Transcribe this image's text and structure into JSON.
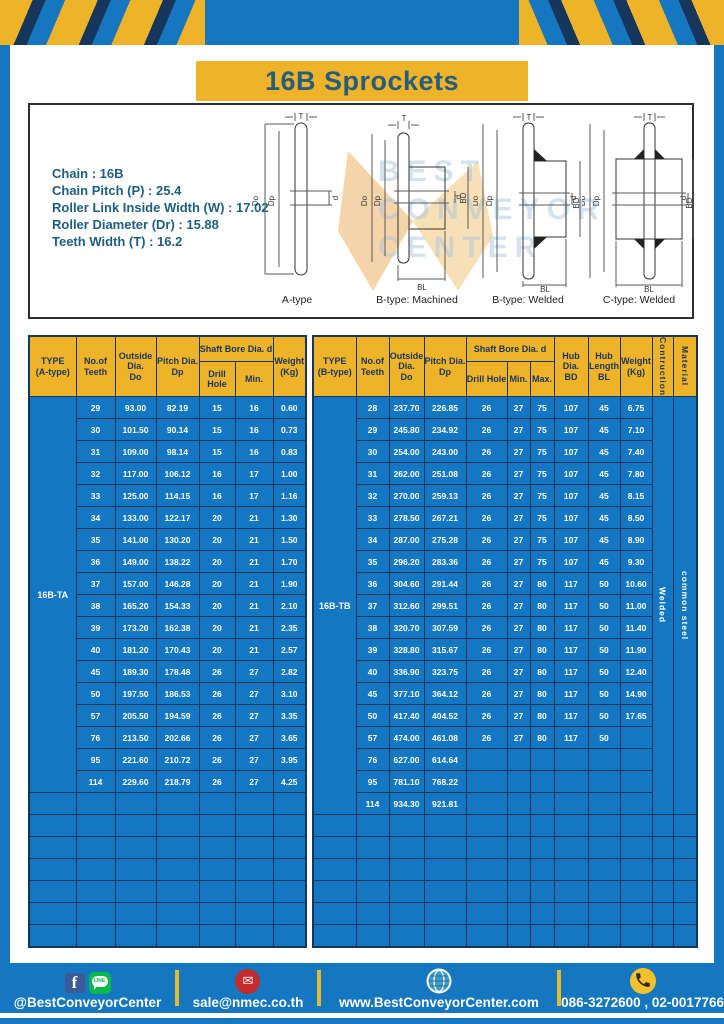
{
  "header": {
    "title": "16B Sprockets"
  },
  "specs": {
    "lines": [
      "Chain  :  16B",
      "Chain Pitch (P)  :  25.4",
      "Roller Link Inside Width (W)  :  17.02",
      "Roller Diameter (Dr)  : 15.88",
      "Teeth Width (T)  :  16.2"
    ]
  },
  "watermark": {
    "lines": [
      "BEST",
      "CONVEYOR",
      "CENTER"
    ]
  },
  "drawings": {
    "captions": [
      "A-type",
      "B-type: Machined",
      "B-type: Welded",
      "C-type: Welded"
    ],
    "dims": {
      "t": "T",
      "outer": "Do",
      "pitch": "Dp",
      "bore": "d",
      "hub_dia": "BD",
      "hub_len": "BL"
    }
  },
  "left_table": {
    "headers": {
      "type": "TYPE\n(A-type)",
      "teeth": "No.of\nTeeth",
      "outside": "Outside\nDia.\nDo",
      "pitch": "Pitch Dia.\nDp",
      "shaft_bore": "Shaft Bore Dia. d",
      "drill": "Drill Hole",
      "min": "Min.",
      "weight": "Weight\n(Kg)"
    },
    "type_label": "16B-TA",
    "total_cols": 7,
    "empty_rows": 7,
    "rows": [
      [
        "29",
        "93.00",
        "82.19",
        "15",
        "16",
        "0.60"
      ],
      [
        "30",
        "101.50",
        "90.14",
        "15",
        "16",
        "0.73"
      ],
      [
        "31",
        "109.00",
        "98.14",
        "15",
        "16",
        "0.83"
      ],
      [
        "32",
        "117.00",
        "106.12",
        "16",
        "17",
        "1.00"
      ],
      [
        "33",
        "125.00",
        "114.15",
        "16",
        "17",
        "1.16"
      ],
      [
        "34",
        "133.00",
        "122.17",
        "20",
        "21",
        "1.30"
      ],
      [
        "35",
        "141.00",
        "130.20",
        "20",
        "21",
        "1.50"
      ],
      [
        "36",
        "149.00",
        "138.22",
        "20",
        "21",
        "1.70"
      ],
      [
        "37",
        "157.00",
        "146.28",
        "20",
        "21",
        "1.90"
      ],
      [
        "38",
        "165.20",
        "154.33",
        "20",
        "21",
        "2.10"
      ],
      [
        "39",
        "173.20",
        "162.38",
        "20",
        "21",
        "2.35"
      ],
      [
        "40",
        "181.20",
        "170.43",
        "20",
        "21",
        "2.57"
      ],
      [
        "45",
        "189.30",
        "178.48",
        "26",
        "27",
        "2.82"
      ],
      [
        "50",
        "197.50",
        "186.53",
        "26",
        "27",
        "3.10"
      ],
      [
        "57",
        "205.50",
        "194.59",
        "26",
        "27",
        "3.35"
      ],
      [
        "76",
        "213.50",
        "202.66",
        "26",
        "27",
        "3.65"
      ],
      [
        "95",
        "221.60",
        "210.72",
        "26",
        "27",
        "3.95"
      ],
      [
        "114",
        "229.60",
        "218.79",
        "26",
        "27",
        "4.25"
      ]
    ]
  },
  "right_table": {
    "headers": {
      "type": "TYPE\n(B-type)",
      "teeth": "No.of\nTeeth",
      "outside": "Outside\nDia.\nDo",
      "pitch": "Pitch Dia.\nDp",
      "shaft_bore": "Shaft Bore Dia. d",
      "drill": "Drill Hole",
      "min": "Min.",
      "max": "Max.",
      "hub_dia": "Hub Dia.\nBD",
      "hub_len": "Hub\nLength\nBL",
      "weight": "Weight\n(Kg)",
      "construction": "Contruction",
      "material": "Material"
    },
    "type_label": "16B-TB",
    "construction_value": "Welded",
    "material_value": "common steel",
    "total_cols": 12,
    "empty_rows": 6,
    "rows": [
      [
        "28",
        "237.70",
        "226.85",
        "26",
        "27",
        "75",
        "107",
        "45",
        "6.75"
      ],
      [
        "29",
        "245.80",
        "234.92",
        "26",
        "27",
        "75",
        "107",
        "45",
        "7.10"
      ],
      [
        "30",
        "254.00",
        "243.00",
        "26",
        "27",
        "75",
        "107",
        "45",
        "7.40"
      ],
      [
        "31",
        "262.00",
        "251.08",
        "26",
        "27",
        "75",
        "107",
        "45",
        "7.80"
      ],
      [
        "32",
        "270.00",
        "259.13",
        "26",
        "27",
        "75",
        "107",
        "45",
        "8.15"
      ],
      [
        "33",
        "278.50",
        "267.21",
        "26",
        "27",
        "75",
        "107",
        "45",
        "8.50"
      ],
      [
        "34",
        "287.00",
        "275.28",
        "26",
        "27",
        "75",
        "107",
        "45",
        "8.90"
      ],
      [
        "35",
        "296.20",
        "283.36",
        "26",
        "27",
        "75",
        "107",
        "45",
        "9.30"
      ],
      [
        "36",
        "304.60",
        "291.44",
        "26",
        "27",
        "80",
        "117",
        "50",
        "10.60"
      ],
      [
        "37",
        "312.60",
        "299.51",
        "26",
        "27",
        "80",
        "117",
        "50",
        "11.00"
      ],
      [
        "38",
        "320.70",
        "307.59",
        "26",
        "27",
        "80",
        "117",
        "50",
        "11.40"
      ],
      [
        "39",
        "328.80",
        "315.67",
        "26",
        "27",
        "80",
        "117",
        "50",
        "11.90"
      ],
      [
        "40",
        "336.90",
        "323.75",
        "26",
        "27",
        "80",
        "117",
        "50",
        "12.40"
      ],
      [
        "45",
        "377.10",
        "364.12",
        "26",
        "27",
        "80",
        "117",
        "50",
        "14.90"
      ],
      [
        "50",
        "417.40",
        "404.52",
        "26",
        "27",
        "80",
        "117",
        "50",
        "17.65"
      ],
      [
        "57",
        "474.00",
        "461.08",
        "26",
        "27",
        "80",
        "117",
        "50",
        ""
      ],
      [
        "76",
        "627.00",
        "614.64",
        "",
        "",
        "",
        "",
        "",
        ""
      ],
      [
        "95",
        "781.10",
        "768.22",
        "",
        "",
        "",
        "",
        "",
        ""
      ],
      [
        "114",
        "934.30",
        "921.81",
        "",
        "",
        "",
        "",
        "",
        ""
      ]
    ]
  },
  "footer": {
    "line_badge": "LINE",
    "sections": [
      {
        "icons": [
          "facebook-icon",
          "line-icon"
        ],
        "label": "@BestConveyorCenter"
      },
      {
        "icons": [
          "email-icon"
        ],
        "label": "sale@nmec.co.th"
      },
      {
        "icons": [
          "globe-icon"
        ],
        "label": "www.BestConveyorCenter.com"
      },
      {
        "icons": [
          "phone-icon"
        ],
        "label": "086-3272600 , 02-0017766"
      }
    ]
  },
  "colors": {
    "band_blue": "#1577bf",
    "table_blue": "#1377c4",
    "yellow": "#efb32a",
    "navy": "#16365c",
    "heading_text": "#265d7c"
  }
}
